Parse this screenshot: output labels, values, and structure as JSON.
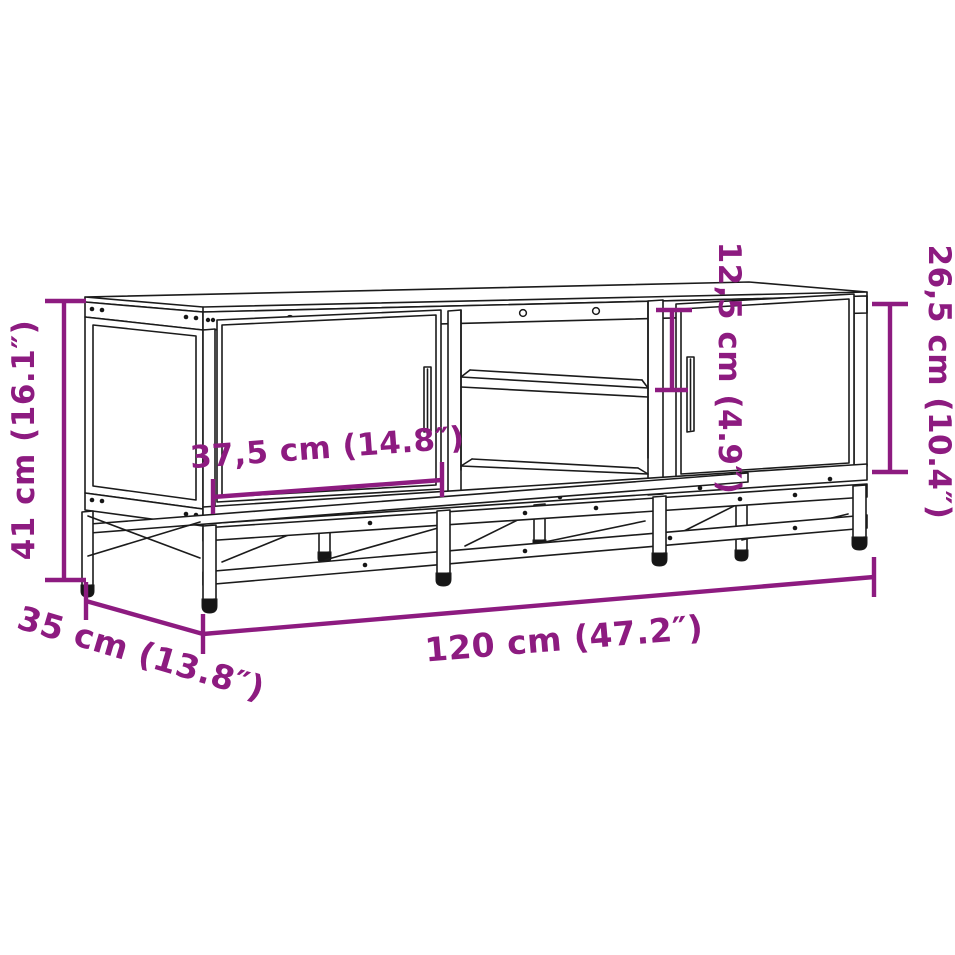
{
  "page": {
    "background_color": "#ffffff",
    "kind": "furniture dimension diagram"
  },
  "drawing": {
    "subject": "TV cabinet with metal base frame, two doors and open middle shelf",
    "line_color": "#1b1b1b",
    "accent_color": "#8D1B80"
  },
  "dimensions": [
    {
      "id": "overall-height",
      "label": "41 cm (16.1″)",
      "cm": "41",
      "inches": "16.1",
      "orientation": "vertical",
      "position": "left"
    },
    {
      "id": "door-width",
      "label": "37,5 cm (14.8″)",
      "cm": "37,5",
      "inches": "14.8",
      "orientation": "horizontal",
      "position": "left-door"
    },
    {
      "id": "shelf-opening-height",
      "label": "12,5 cm (4.9″)",
      "cm": "12,5",
      "inches": "4.9",
      "orientation": "vertical",
      "position": "middle"
    },
    {
      "id": "door-height",
      "label": "26,5 cm (10.4″)",
      "cm": "26,5",
      "inches": "10.4",
      "orientation": "vertical",
      "position": "right"
    },
    {
      "id": "overall-width",
      "label": "120 cm (47.2″)",
      "cm": "120",
      "inches": "47.2",
      "orientation": "horizontal",
      "position": "bottom"
    },
    {
      "id": "overall-depth",
      "label": "35 cm (13.8″)",
      "cm": "35",
      "inches": "13.8",
      "orientation": "diagonal",
      "position": "bottom-left"
    }
  ]
}
